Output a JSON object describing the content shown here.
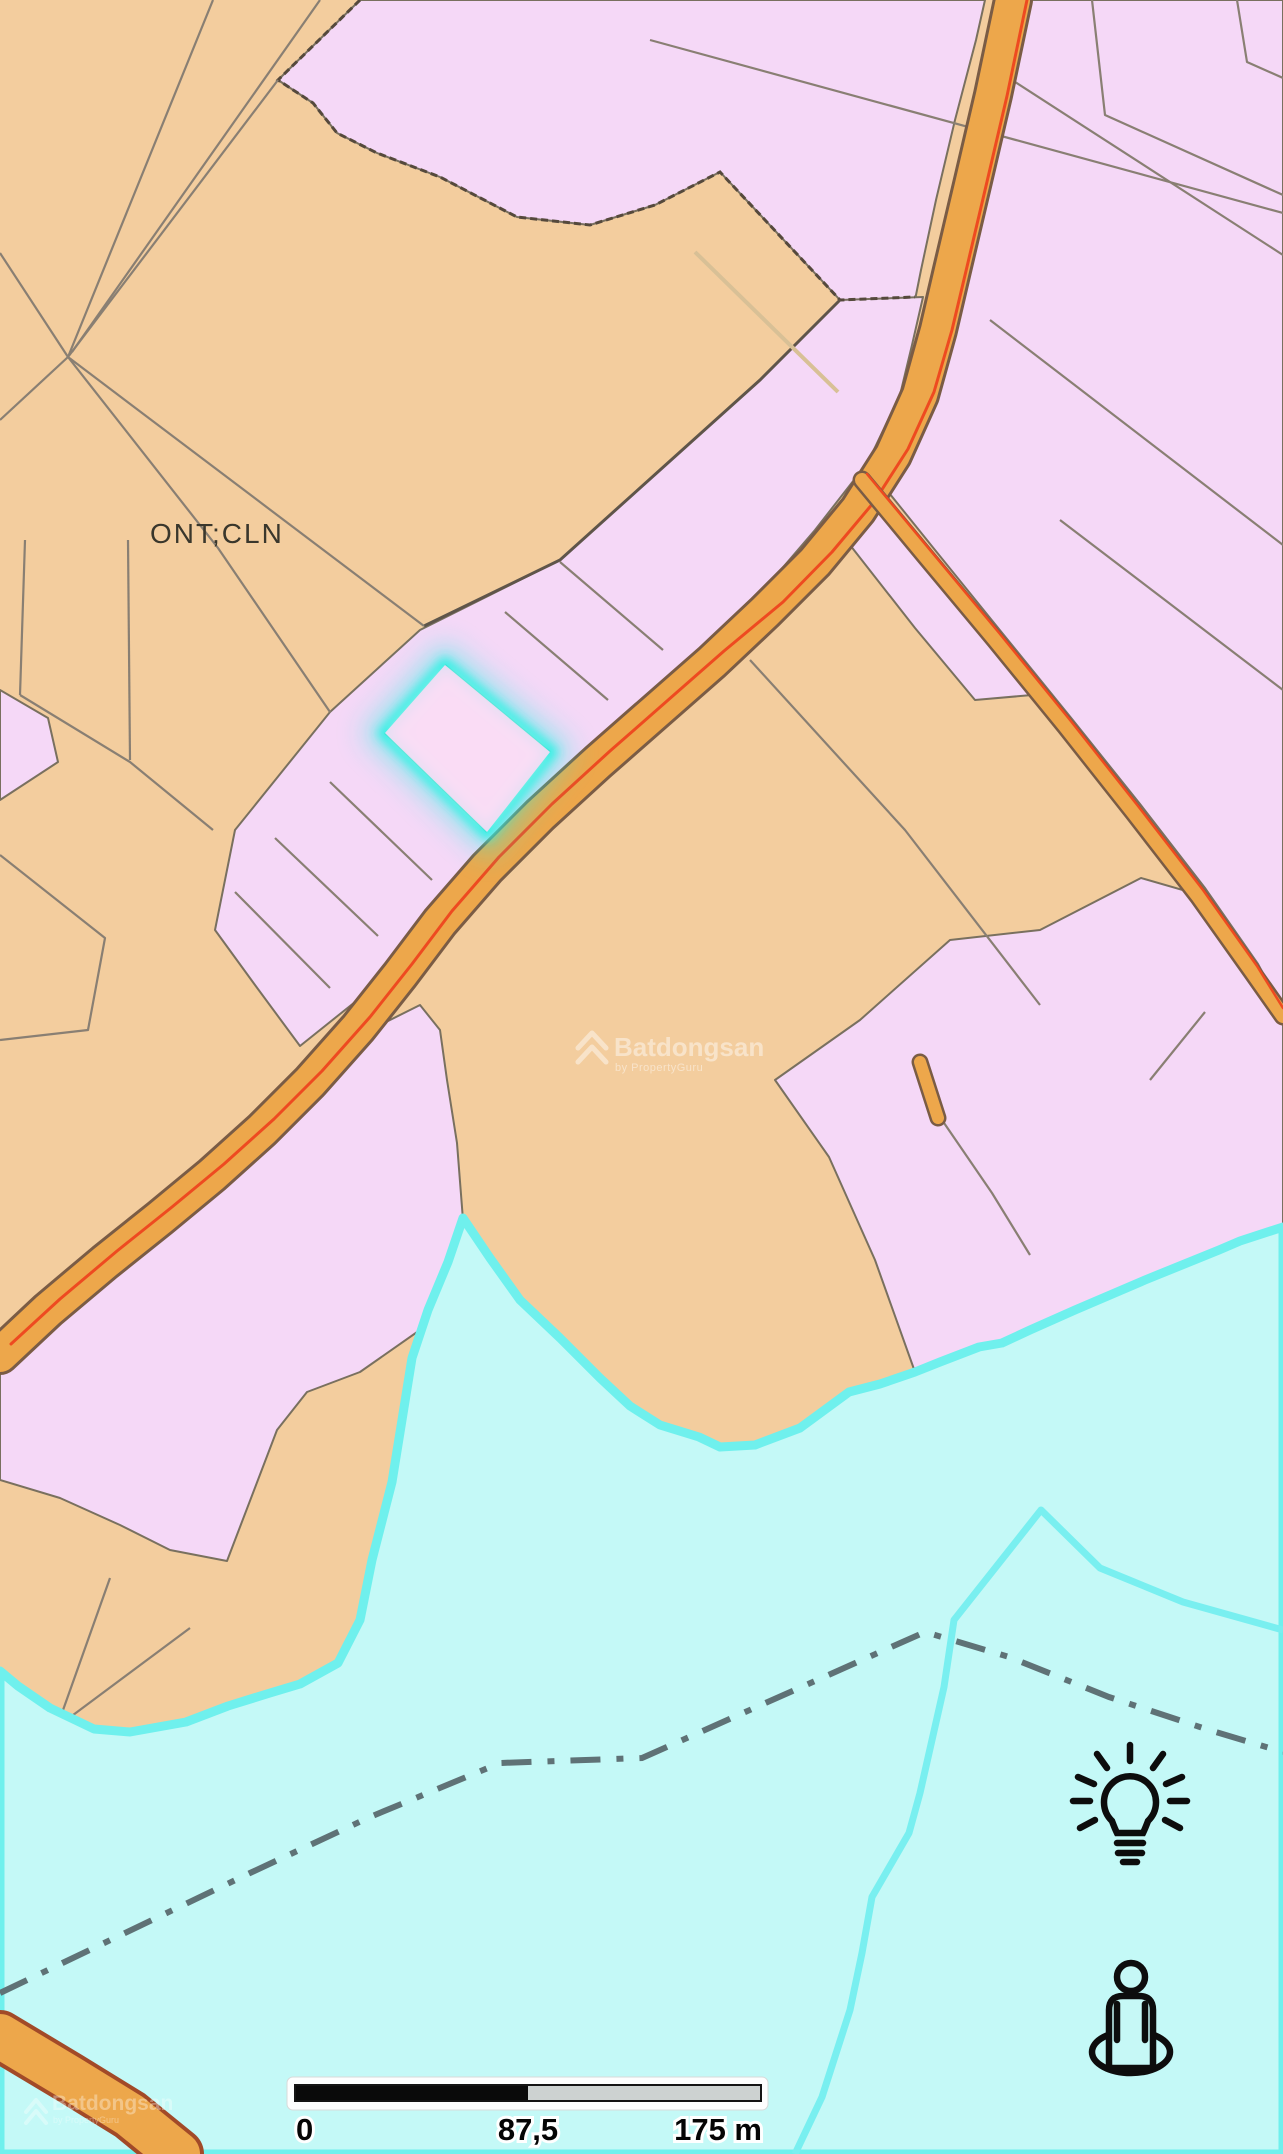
{
  "map": {
    "zone_label": "ONT;CLN",
    "scale_bar": {
      "start": "0",
      "mid": "87,5",
      "end": "175 m"
    },
    "watermark": {
      "brand": "Batdongsan",
      "byline": "by PropertyGuru"
    },
    "controls": {
      "suggest_icon": "lightbulb",
      "street_view_icon": "pegman"
    },
    "colors": {
      "land_agricultural_orange": "#f3cd9e",
      "land_residential_violet": "#f5d8f7",
      "road_fill": "#eda74b",
      "road_casing": "#7a5c45",
      "road_red_line": "#ee4a20",
      "water_fill": "#c4f9f7",
      "water_shore": "#6ff0ed",
      "highlight_cyan": "#2ef2e4",
      "boundary_dash_gray": "#5f7276"
    }
  }
}
